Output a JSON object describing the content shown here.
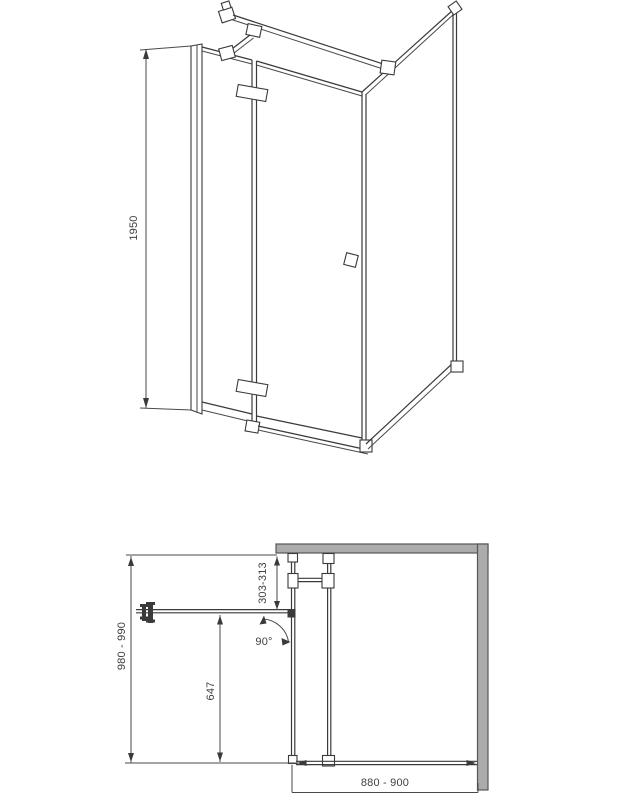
{
  "drawing": {
    "subject": "shower-enclosure-technical-drawing",
    "colors": {
      "background": "#ffffff",
      "line": "#3a3a3a",
      "wall_fill": "#ababab",
      "text": "#3f3f3f"
    },
    "dimensions": {
      "height": "1950",
      "depth": "980 - 990",
      "width": "880 - 900",
      "fixed_segment": "303-313",
      "door_length": "647",
      "door_angle": "90°"
    }
  }
}
